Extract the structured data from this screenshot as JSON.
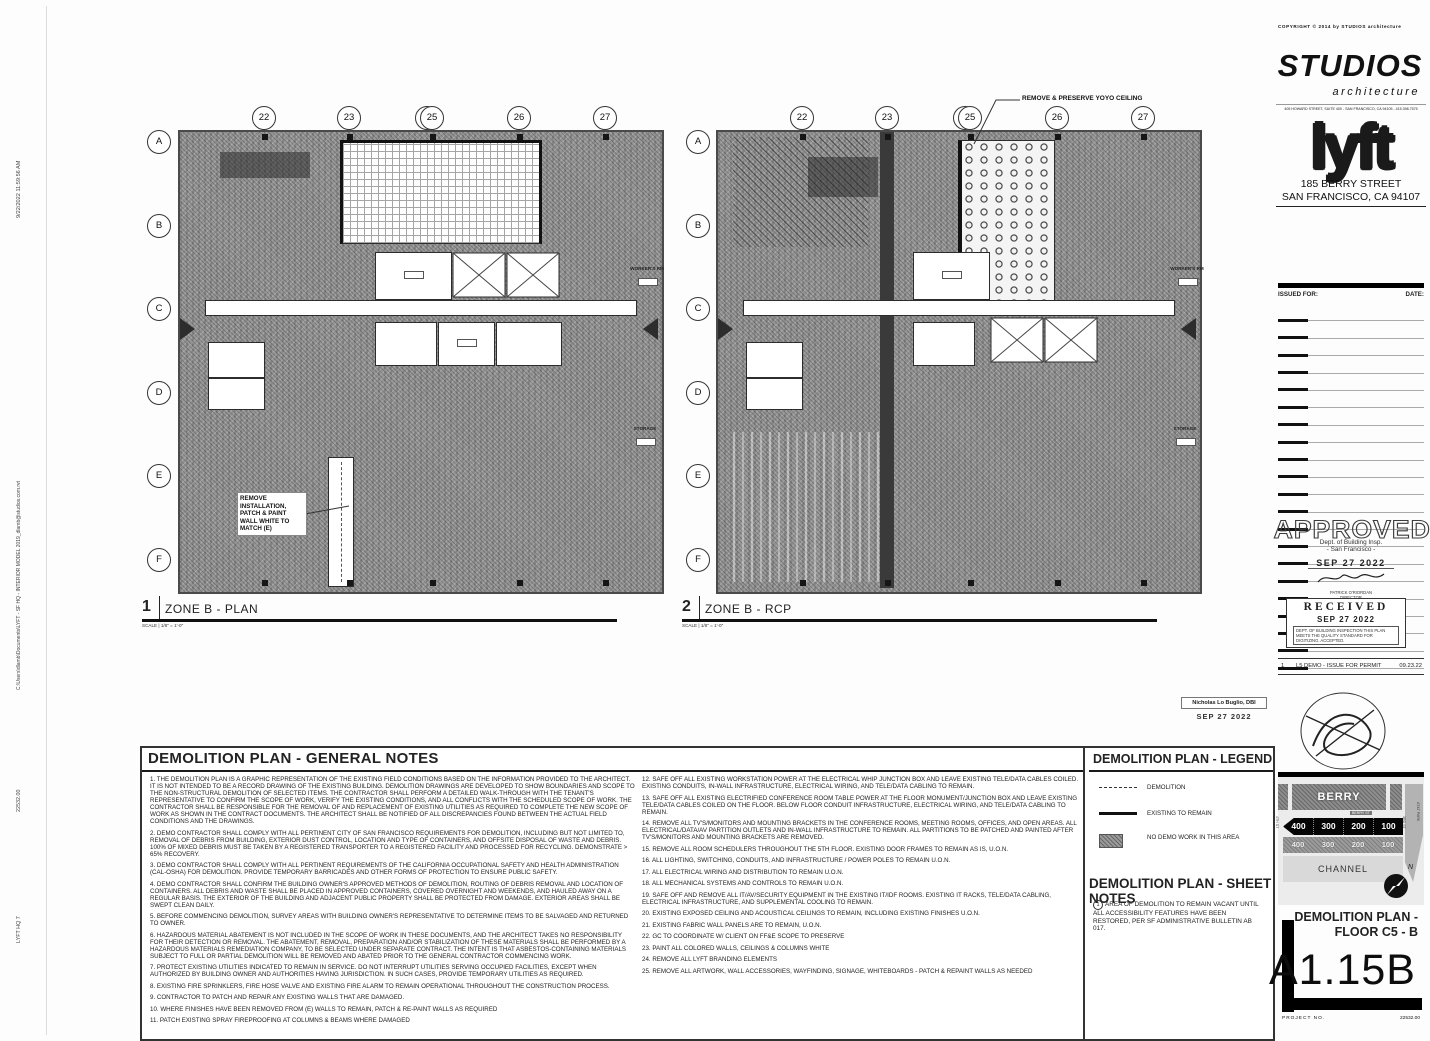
{
  "edge": {
    "timestamp": "9/22/2022 11:59:56 AM",
    "file_path": "C:\\Users\\dlamb\\Documents\\LYFT - SF HQ - INTERIOR MODEL 2019_dlamb@studios.com.rvt",
    "project_no_vertical": "22532.00",
    "project_name_vertical": "LYFT HQ 7"
  },
  "grid": {
    "columns": [
      "22",
      "23",
      "25",
      "26",
      "27"
    ],
    "column_overlap": "24",
    "rows": [
      "A",
      "B",
      "C",
      "D",
      "E",
      "F"
    ]
  },
  "plans": [
    {
      "number": "1",
      "title": "ZONE B - PLAN",
      "scale_label": "SCALE",
      "scale": "1/8\" = 1'-0\"",
      "annotation": "REMOVE INSTALLATION, PATCH & PAINT WALL WHITE TO MATCH (E)",
      "callout_workers": "WORKER'S RM",
      "callout_storage": "STORAGE"
    },
    {
      "number": "2",
      "title": "ZONE B - RCP",
      "scale_label": "SCALE",
      "scale": "1/8\" = 1'-0\"",
      "annotation": "REMOVE & PRESERVE YOYO CEILING",
      "callout_workers": "WORKER'S RM",
      "callout_storage": "STORAGE"
    }
  ],
  "notes": {
    "title": "DEMOLITION PLAN - GENERAL NOTES",
    "left": [
      "1. THE DEMOLITION PLAN IS A GRAPHIC REPRESENTATION OF THE EXISTING FIELD CONDITIONS BASED ON THE INFORMATION PROVIDED TO THE ARCHITECT. IT IS NOT INTENDED TO BE A RECORD DRAWING OF THE EXISTING BUILDING.  DEMOLITION DRAWINGS ARE DEVELOPED TO SHOW BOUNDARIES AND SCOPE TO THE NON-STRUCTURAL DEMOLITION OF SELECTED ITEMS.  THE CONTRACTOR SHALL PERFORM A DETAILED WALK-THROUGH WITH THE TENANT'S REPRESENTATIVE TO CONFIRM THE SCOPE OF WORK, VERIFY THE EXISTING CONDITIONS, AND ALL CONFLICTS WITH THE SCHEDULED SCOPE OF WORK.  THE CONTRACTOR SHALL BE RESPONSIBLE FOR THE REMOVAL OF AND REPLACEMENT OF EXISTING UTILITIES AS REQUIRED TO COMPLETE THE NEW SCOPE OF WORK AS SHOWN IN THE CONTRACT DOCUMENTS.  THE ARCHITECT SHALL BE NOTIFIED OF ALL DISCREPANCIES FOUND  BETWEEN THE ACTUAL FIELD CONDITIONS AND THE DRAWINGS.",
      "2. DEMO CONTRACTOR SHALL COMPLY WITH ALL PERTINENT CITY OF SAN FRANCISCO REQUIREMENTS FOR DEMOLITION, INCLUDING BUT NOT LIMITED TO, REMOVAL OF DEBRIS FROM BUILDING, EXTERIOR DUST CONTROL, LOCATION AND TYPE OF CONTAINERS, AND OFFSITE DISPOSAL OF WASTE AND DEBRIS.  100% OF MIXED DEBRIS MUST BE TAKEN BY A REGISTERED TRANSPORTER TO A REGISTERED FACILITY AND PROCESSED FOR RECYCLING. DEMONSTRATE > 65% RECOVERY.",
      "3. DEMO CONTRACTOR SHALL COMPLY WITH ALL PERTINENT REQUIREMENTS OF THE CALIFORNIA OCCUPATIONAL SAFETY AND HEALTH ADMINISTRATION (CAL-OSHA) FOR DEMOLITION.  PROVIDE TEMPORARY BARRICADES AND OTHER FORMS OF PROTECTION TO ENSURE PUBLIC SAFETY.",
      "4. DEMO CONTRACTOR SHALL CONFIRM THE BUILDING OWNER'S APPROVED METHODS OF DEMOLITION, ROUTING OF DEBRIS REMOVAL AND LOCATION OF CONTAINERS.  ALL DEBRIS AND WASTE SHALL BE PLACED IN APPROVED CONTAINERS, COVERED OVERNIGHT AND WEEKENDS, AND HAULED AWAY ON A REGULAR BASIS.  THE EXTERIOR OF THE BUILDING AND ADJACENT PUBLIC PROPERTY SHALL BE PROTECTED FROM DAMAGE.  EXTERIOR AREAS SHALL BE SWEPT CLEAN DAILY.",
      "5. BEFORE COMMENCING DEMOLITION, SURVEY AREAS WITH BUILDING OWNER'S REPRESENTATIVE TO DETERMINE ITEMS TO BE SALVAGED AND RETURNED TO OWNER.",
      "6. HAZARDOUS MATERIAL ABATEMENT IS NOT INCLUDED IN THE SCOPE OF WORK IN THESE DOCUMENTS, AND THE ARCHITECT TAKES NO RESPONSIBILITY FOR THEIR DETECTION OR REMOVAL. THE ABATEMENT, REMOVAL, PREPARATION AND/OR STABILIZATION OF THESE MATERIALS SHALL BE PERFORMED BY A HAZARDOUS MATERIALS REMEDIATION COMPANY, TO BE SELECTED UNDER SEPARATE CONTRACT. THE INTENT IS THAT ASBESTOS-CONTAINING MATERIALS SUBJECT TO FULL OR PARTIAL DEMOLITION WILL BE REMOVED AND ABATED PRIOR TO THE GENERAL CONTRACTOR COMMENCING WORK.",
      "7. PROTECT EXISTING UTILITIES INDICATED TO REMAIN IN SERVICE.  DO NOT INTERRUPT UTILITIES SERVING OCCUPIED FACILITIES, EXCEPT WHEN AUTHORIZED BY BUILDING OWNER AND AUTHORITIES HAVING JURISDICTION. IN SUCH CASES, PROVIDE TEMPORARY UTILITIES AS REQUIRED.",
      "8. EXISTING FIRE SPRINKLERS, FIRE HOSE VALVE AND EXISTING FIRE ALARM TO REMAIN OPERATIONAL THROUGHOUT THE CONSTRUCTION PROCESS.",
      "9. CONTRACTOR TO PATCH AND REPAIR ANY EXISTING WALLS THAT ARE DAMAGED.",
      "10. WHERE FINISHES HAVE BEEN REMOVED FROM (E) WALLS TO REMAIN, PATCH & RE-PAINT WALLS AS REQUIRED",
      "11.  PATCH EXISTING SPRAY FIREPROOFING AT COLUMNS & BEAMS WHERE DAMAGED"
    ],
    "right": [
      "12. SAFE OFF ALL EXISTING WORKSTATION POWER AT THE ELECTRICAL WHIP JUNCTION BOX AND LEAVE EXISTING TELE/DATA CABLES COILED.  EXISTING CONDUITS, IN-WALL INFRASTRUCTURE, ELECTRICAL WIRING, AND TELE/DATA CABLING TO REMAIN.",
      "13. SAFE OFF ALL EXISTING ELECTRIFIED CONFERENCE ROOM TABLE POWER AT THE FLOOR MONUMENT/JUNCTION BOX AND LEAVE EXISTING TELE/DATA CABLES COILED ON THE FLOOR.  BELOW FLOOR CONDUIT INFRASTRUCTURE, ELECTRICAL WIRING, AND TELE/DATA CABLING TO REMAIN.",
      "14. REMOVE ALL TV'S/MONITORS AND MOUNTING BRACKETS IN THE CONFERENCE ROOMS, MEETING ROOMS, OFFICES, AND OPEN AREAS.  ALL ELECTRICAL/DATA/AV PARTITION OUTLETS AND IN-WALL INFRASTRUCTURE TO REMAIN.  ALL PARTITIONS TO BE PATCHED AND PAINTED AFTER TV'S/MONITORS AND MOUNTING BRACKETS ARE REMOVED.",
      "15. REMOVE ALL ROOM SCHEDULERS THROUGHOUT THE 5TH FLOOR.  EXISTING DOOR FRAMES TO REMAIN AS IS, U.O.N.",
      "16. ALL LIGHTING, SWITCHING, CONDUITS, AND INFRASTRUCTURE / POWER POLES TO REMAIN U.O.N.",
      "17. ALL ELECTRICAL WIRING AND DISTRIBUTION TO REMAIN U.O.N.",
      "18. ALL MECHANICAL SYSTEMS AND CONTROLS TO REMAIN U.O.N.",
      "19. SAFE OFF AND REMOVE ALL IT/AV/SECURITY EQUIPMENT IN THE EXISTING IT/IDF ROOMS.  EXISTING IT RACKS, TELE/DATA CABLING, ELECTRICAL INFRASTRUCTURE, AND SUPPLEMENTAL COOLING TO REMAIN.",
      "20. EXISTING EXPOSED CEILING AND ACOUSTICAL CEILINGS TO REMAIN, INCLUDING EXISTING FINISHES U.O.N.",
      "21. EXISTING FABRIC WALL PANELS ARE TO REMAIN, U.O.N.",
      "22. GC TO COORDINATE W/ CLIENT ON FF&E SCOPE TO PRESERVE",
      "23. PAINT ALL COLORED WALLS, CEILINGS & COLUMNS WHITE",
      "24. REMOVE ALL LYFT BRANDING ELEMENTS",
      "25. REMOVE ALL ARTWORK, WALL ACCESSORIES, WAYFINDING, SIGNAGE, WHITEBOARDS - PATCH & REPAINT WALLS AS NEEDED"
    ]
  },
  "legend": {
    "title": "DEMOLITION PLAN - LEGEND",
    "items": [
      {
        "symbol": "dashed-line",
        "label": "DEMOLITION"
      },
      {
        "symbol": "solid-line",
        "label": "EXISTING TO REMAIN"
      },
      {
        "symbol": "hatch-box",
        "label": "NO DEMO WORK IN THIS AREA"
      }
    ]
  },
  "sheet_notes": {
    "title": "DEMOLITION PLAN - SHEET NOTES",
    "items": [
      {
        "num": "1",
        "text": "AREA OF DEMOLITION TO REMAIN VACANT UNTIL ALL ACCESSIBILITY FEATURES HAVE BEEN RESTORED, PER SF ADMINISTRATIVE BULLETIN AB 017."
      }
    ]
  },
  "stamps": {
    "dbi_name": "Nicholas Lo Buglio, DBI",
    "dbi_date": "SEP 27 2022",
    "approved": {
      "word": "APPROVED",
      "line1": "Dept. of Building Insp.",
      "line2": "- San Francisco -",
      "date": "SEP 27 2022",
      "sig_name": "PATRICK O'RIORDAN",
      "sig_title": "DIRECTOR",
      "sig_dept": "DEPT OF BUILDING INSPECTION"
    },
    "received": {
      "word": "RECEIVED",
      "date": "SEP 27 2022",
      "lines": "DEPT. OF BUILDING INSPECTION  THIS PLAN MEETS THE QUALITY STANDARD FOR DIGITIZING. ACCEPTED."
    }
  },
  "titleblock": {
    "copyright": "COPYRIGHT © 2014 by STUDIOS architecture",
    "studios": "STUDIOS",
    "architecture": "architecture",
    "studios_address": "405 HOWARD STREET, SUITE 400 - SAN FRANCISCO, CA 94105 - 415.398.7575",
    "lyft": "lyft",
    "project_address1": "185 BERRY STREET",
    "project_address2": "SAN FRANCISCO, CA 94107",
    "issued_for_label": "ISSUED FOR:",
    "date_label": "DATE:",
    "revision": {
      "no": "1",
      "desc": "L5 DEMO - ISSUE FOR PERMIT",
      "date": "09.23.22"
    },
    "keymap": {
      "berry": "BERRY",
      "berry_st": "BERRY ST",
      "blocks": [
        "400",
        "300",
        "200",
        "100"
      ],
      "channel": "CHANNEL",
      "left_street": "4TH ST",
      "right_street": "3RD ST",
      "park": "AT&T PARK",
      "north": "N"
    },
    "sheet_title1": "DEMOLITION PLAN -",
    "sheet_title2": "FLOOR C5 - B",
    "sheet_number": "A1.15B",
    "project_no_label": "PROJECT NO.",
    "project_no": "22532.00"
  }
}
